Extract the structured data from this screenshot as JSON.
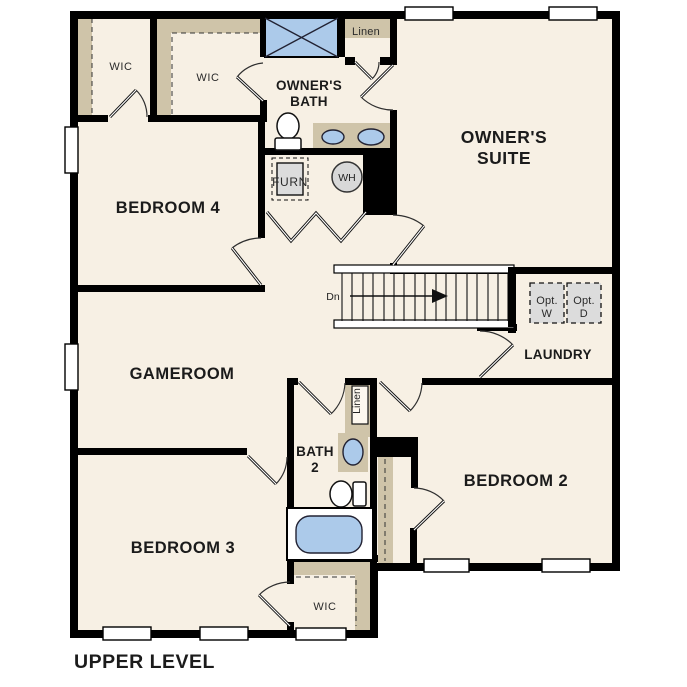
{
  "plan": {
    "title": "UPPER LEVEL",
    "rooms": {
      "owners_suite": {
        "line1": "OWNER'S",
        "line2": "SUITE"
      },
      "owners_bath": {
        "line1": "OWNER'S",
        "line2": "BATH"
      },
      "bedroom4": "BEDROOM 4",
      "bedroom3": "BEDROOM 3",
      "bedroom2": "BEDROOM 2",
      "gameroom": "GAMEROOM",
      "laundry": "LAUNDRY",
      "bath2": {
        "line1": "BATH",
        "line2": "2"
      }
    },
    "closets": {
      "wic_top_left": "WIC",
      "wic_top_mid": "WIC",
      "wic_bottom": "WIC",
      "linen_top": "Linen",
      "linen_bath2": "Linen"
    },
    "fixtures": {
      "furnace": "FURN",
      "water_heater": "WH",
      "opt_washer": {
        "line1": "Opt.",
        "line2": "W"
      },
      "opt_dryer": {
        "line1": "Opt.",
        "line2": "D"
      }
    },
    "stairs": {
      "down_label": "Dn",
      "direction": "right"
    },
    "colors": {
      "background": "#ffffff",
      "floor": "#f7f0e4",
      "wall": "#000000",
      "closet_shelf": "#cfc4a9",
      "water_blue": "#accaea",
      "appliance_gray": "#dcdcdc"
    }
  }
}
